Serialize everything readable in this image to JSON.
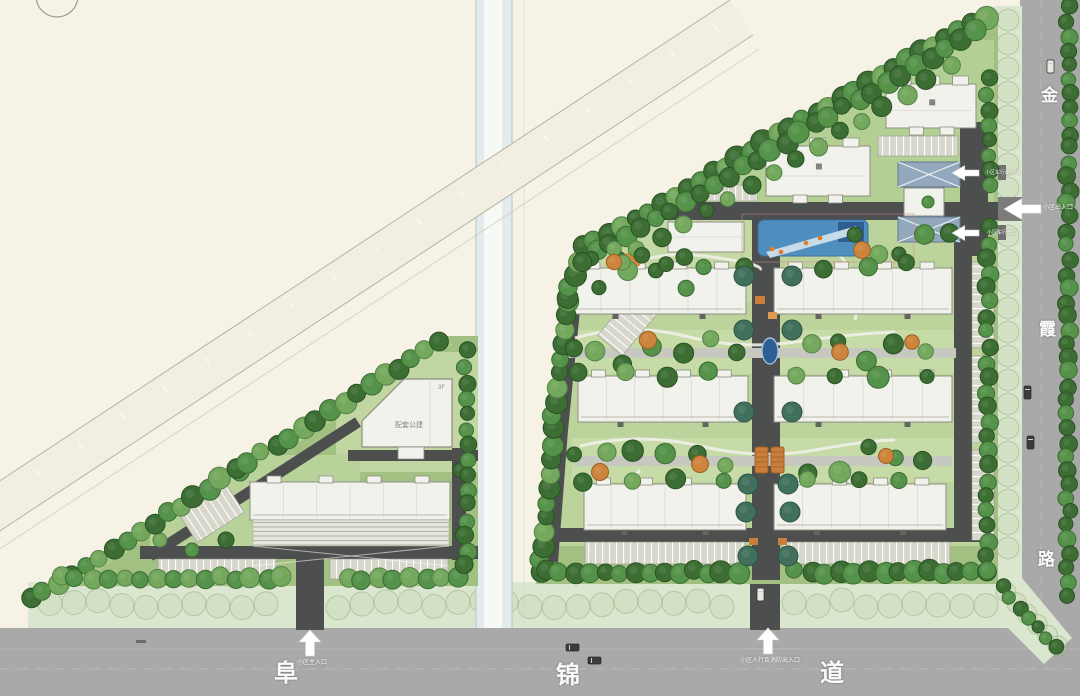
{
  "plan": {
    "type": "residential-master-plan"
  },
  "roads": {
    "east_name": "金霞路",
    "east_chars": [
      "金",
      "霞",
      "路"
    ],
    "south_name": "阜锦道",
    "south_chars": [
      "阜",
      "锦",
      "道"
    ]
  },
  "entrances": {
    "south_main": {
      "label": "小区主入口"
    },
    "south_fire": {
      "label": "小区人行及消防出入口"
    },
    "east_main": {
      "label": "小区出入口"
    },
    "east_vehicle_upper": {
      "label": "小区车行出入口"
    },
    "east_vehicle_lower": {
      "label": "小区车行出口"
    }
  },
  "buildings": {
    "support_public": {
      "label": "配套公建",
      "floors": "3F"
    }
  },
  "colors": {
    "background": "#f6f3e6",
    "road": "#a9a9a9",
    "road_mouth": "#7c7c7a",
    "inner_road": "#4d4e4e",
    "path": "#c7c9c1",
    "site_green": "#a3c083",
    "court_green": "#bcd49c",
    "lawn_green": "#c6dba6",
    "verge_green": "#dbe6cf",
    "canal": "#e3ebec",
    "canal_stripe": "#f7f9f5",
    "band": "#f2efe2",
    "building": "#f2f2ec",
    "building_edge": "#8d8d86",
    "kindergarten_roof": "#92a9bd",
    "water": "#4f8fc0",
    "water_deep": "#2e5e94",
    "accent_orange": "#c97f3b"
  }
}
